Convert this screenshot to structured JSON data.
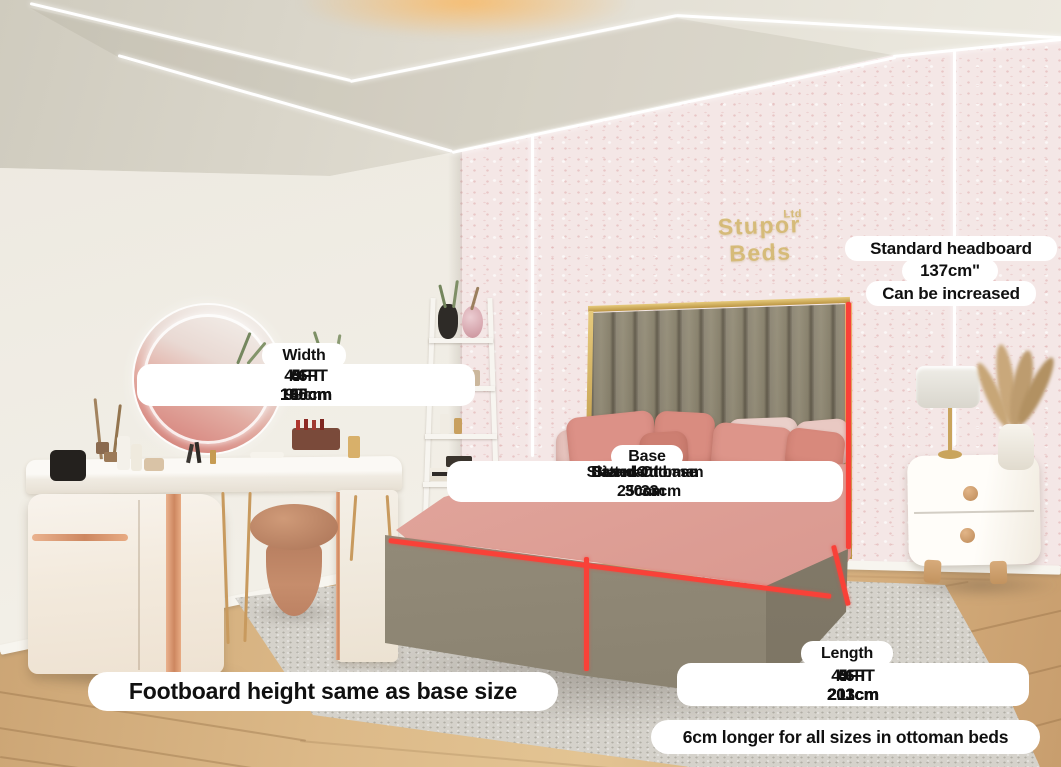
{
  "brand": {
    "name": "Stupor Beds",
    "suffix": "Ltd"
  },
  "annotations": {
    "headboard": {
      "line1": "Standard headboard",
      "line2": "137cm\"",
      "line3": "Can be increased"
    },
    "width": {
      "title": "Width",
      "sizes": [
        "3FT",
        "4FT",
        "4.6FT",
        "5FT",
        "6FT"
      ],
      "values": [
        "99cm",
        "130cm",
        "145cm",
        "160cm",
        "190cm"
      ]
    },
    "base": {
      "title": "Base",
      "types": [
        "Standard base",
        "Slatted Ottoman",
        "Divan Ottoman"
      ],
      "values": [
        "25cm",
        "30cm",
        "33cm"
      ]
    },
    "length": {
      "title": "Length",
      "sizes": [
        "3FT",
        "4FT",
        "4.6FT",
        "5FT",
        "6FT"
      ],
      "values": [
        "203cm",
        "203cm",
        "203cm",
        "211cm",
        "211cm"
      ]
    },
    "footboard_note": "Footboard height same as base size",
    "ottoman_note": "6cm longer for all sizes in ottoman beds"
  },
  "palette": {
    "measure_line": "#f94138",
    "pill_bg": "#ffffff",
    "pill_text": "#101010",
    "logo_gold": "#d2b66b",
    "headboard": "#948c78",
    "gold_trim": "#c9a24e",
    "pillow_salmon": "#dc9187",
    "duvet_pink": "#e0a79d",
    "bed_base": "#948c7a",
    "wallpaper": "#f4e7e6",
    "left_wall": "#f0ede5",
    "floor_wood": "#d4ab7c",
    "rug": "#d5d2cb"
  }
}
